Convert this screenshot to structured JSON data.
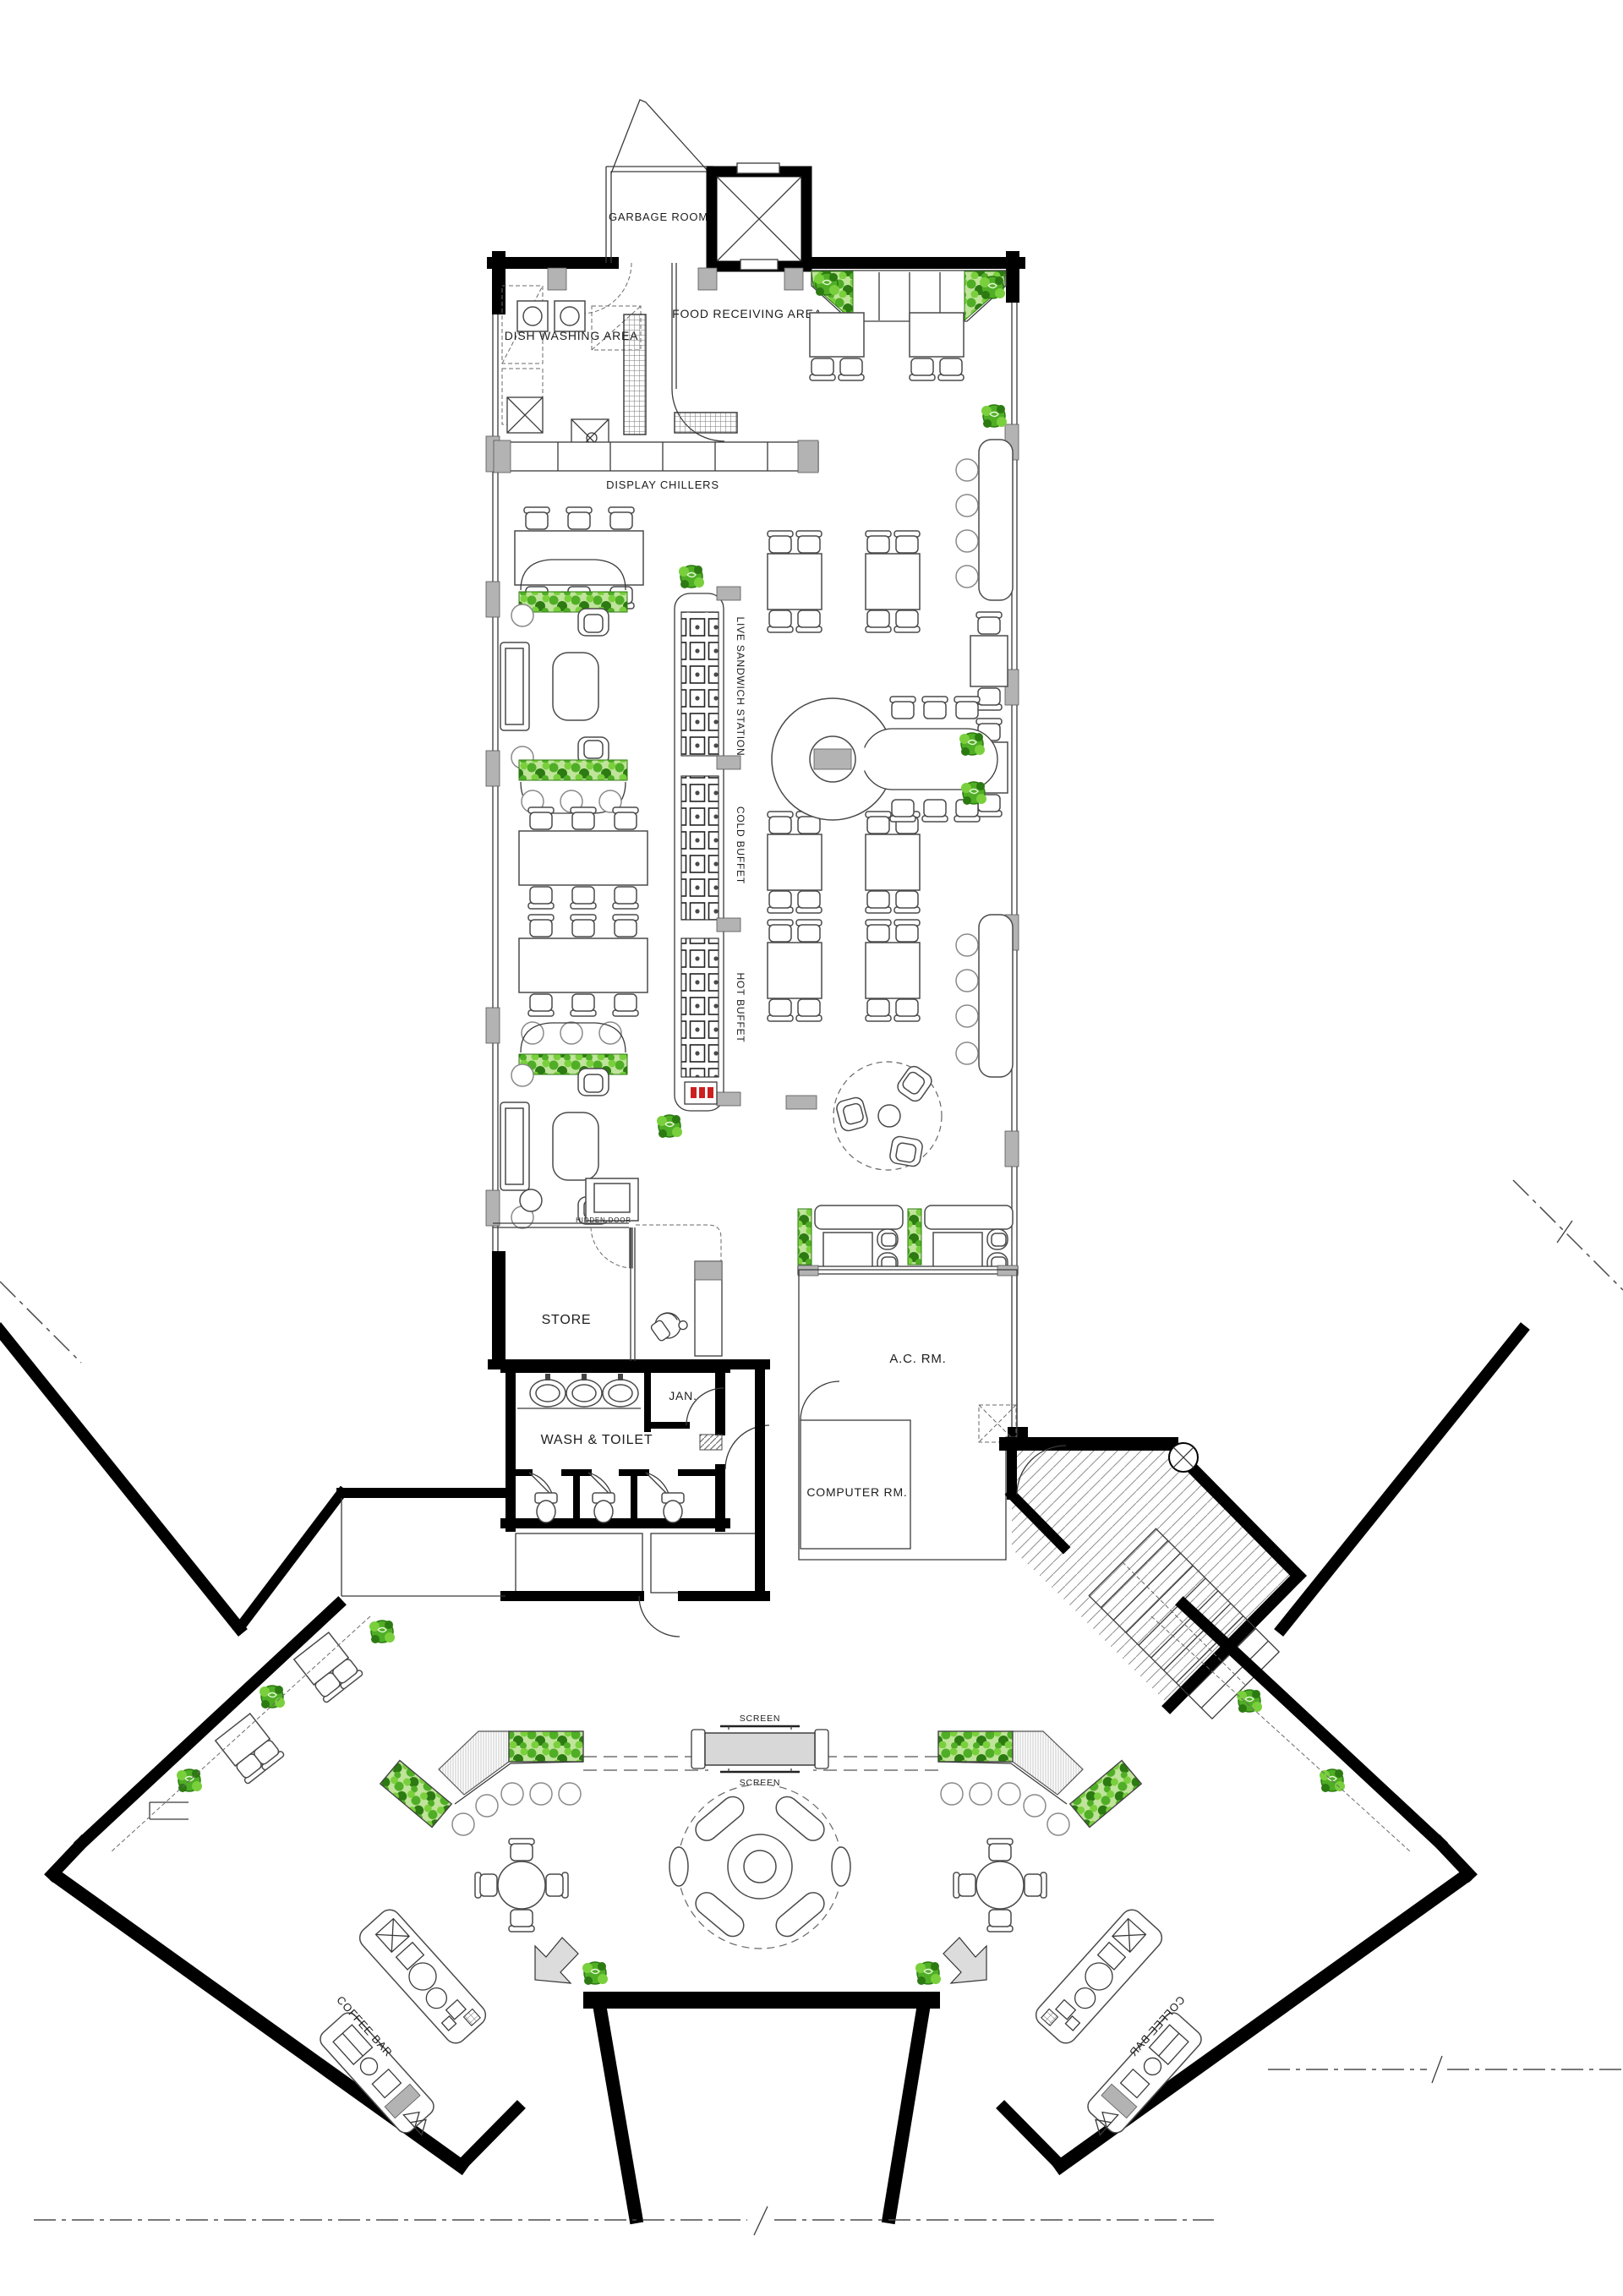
{
  "labels": {
    "garbage_room": "GARBAGE ROOM",
    "food_receiving_area": "FOOD RECEIVING AREA",
    "dish_washing_area": "DISH WASHING AREA",
    "display_chillers": "DISPLAY CHILLERS",
    "live_sandwich_station": "LIVE SANDWICH STATION",
    "cold_buffet": "COLD BUFFET",
    "hot_buffet": "HOT BUFFET",
    "hidden_door": "HIDDEN DOOR",
    "store": "STORE",
    "wash_toilet": "WASH & TOILET",
    "janitor": "JAN.",
    "ac_room": "A.C. RM.",
    "computer_room": "COMPUTER RM.",
    "screen_front": "SCREEN",
    "screen_back": "SCREEN",
    "coffee_bar_left": "COFFEE BAR",
    "coffee_bar_right": "COFFEE BAR"
  },
  "colors": {
    "wall": "#000000",
    "column": "#b3b3b3",
    "screen_fill": "#d8d8d8",
    "arrow_gray": "#dcdcdc",
    "accent_red": "#cc2020",
    "plant_dark": "#2c7a12",
    "plant_mid": "#4fae25",
    "plant_light": "#79d03c",
    "hatch_line": "#8f8f8f"
  }
}
